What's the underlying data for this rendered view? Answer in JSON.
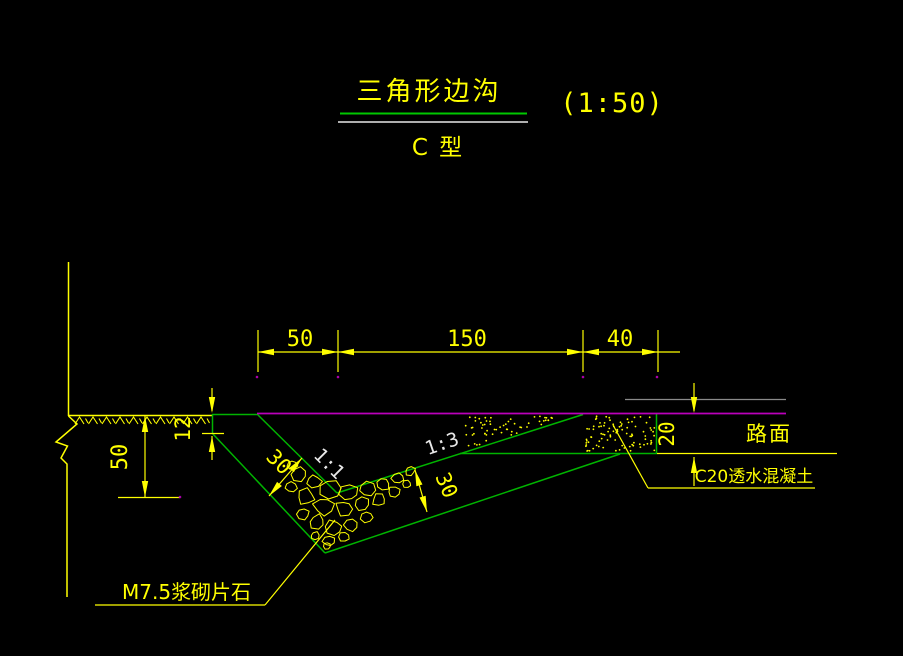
{
  "drawing": {
    "title": "三角形边沟",
    "type_label": "C 型",
    "scale": "(1:50)"
  },
  "labels": {
    "road_surface": "路面",
    "concrete": "C20透水混凝土",
    "masonry": "M7.5浆砌片石",
    "slope_left": "1:1",
    "slope_right": "1:3"
  },
  "dims": {
    "top_left": "50",
    "top_mid": "150",
    "top_right": "40",
    "depth": "50",
    "curb_step": "12",
    "pavement_thickness": "20",
    "lining_left": "30",
    "lining_right": "30"
  },
  "colors": {
    "background": "#000000",
    "line_yellow": "#ffff00",
    "line_green": "#00b400",
    "line_magenta": "#bb00bb",
    "line_white": "#e8e8e8",
    "line_gray": "#8a8a8a"
  }
}
